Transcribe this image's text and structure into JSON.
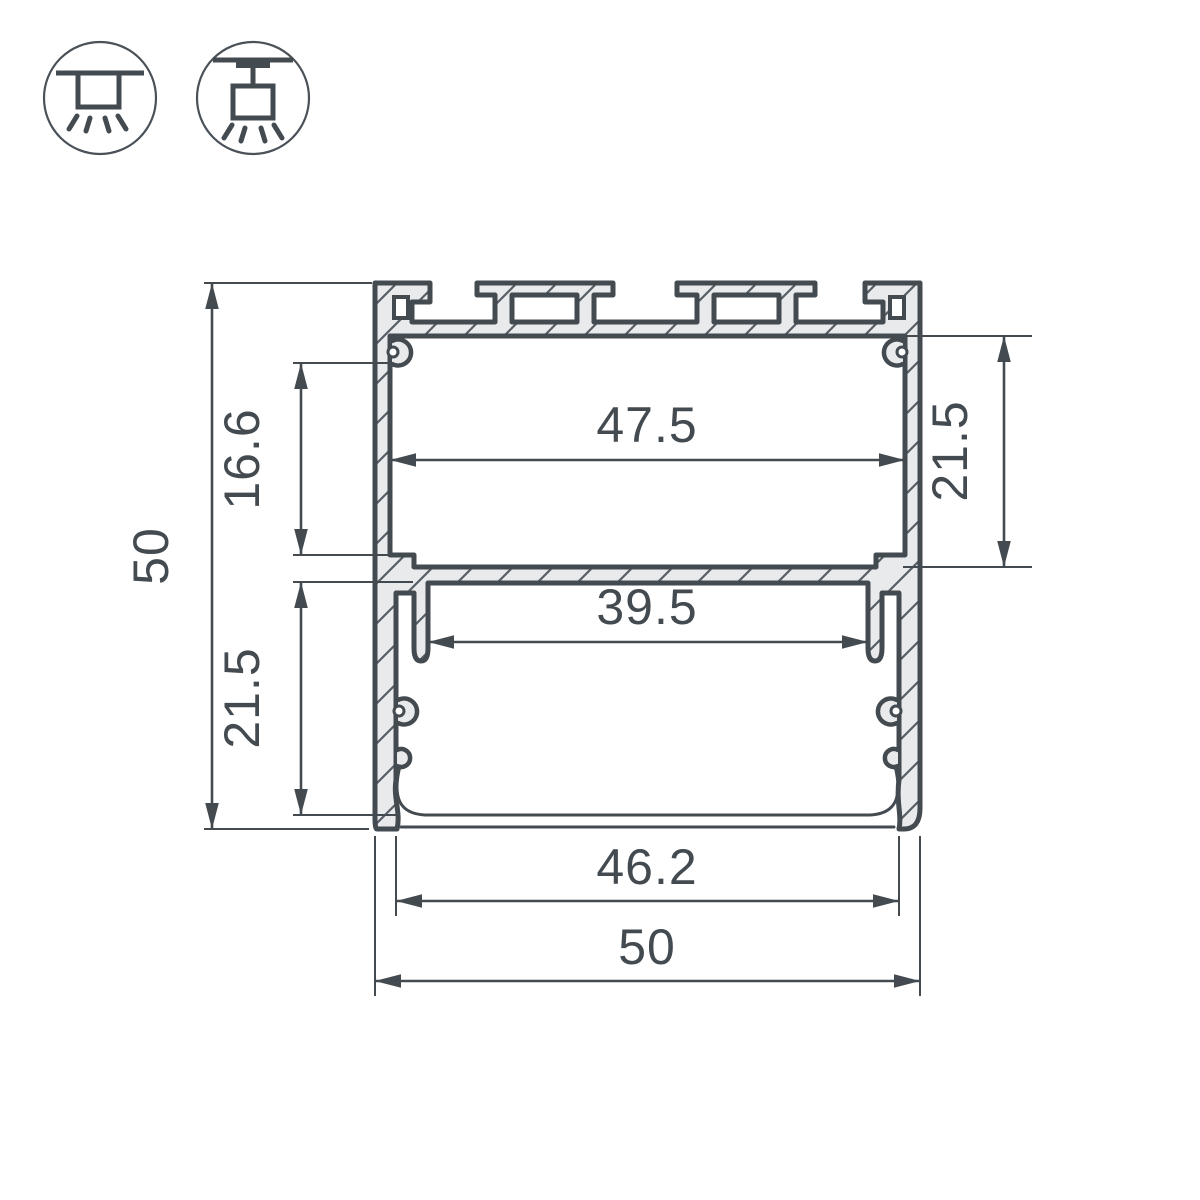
{
  "palette": {
    "line_color": "#434a50",
    "metal_fill": "#e9eaec",
    "background": "#ffffff"
  },
  "icons": {
    "surface_mount": "surface-mount-icon",
    "pendant_mount": "pendant-mount-icon"
  },
  "dimensions": {
    "overall_height": "50",
    "upper_side_height": "16.6",
    "lower_side_height": "21.5",
    "top_inner_width": "47.5",
    "upper_cavity_height": "21.5",
    "mid_inner_width": "39.5",
    "bottom_opening_width": "46.2",
    "overall_width": "50"
  }
}
